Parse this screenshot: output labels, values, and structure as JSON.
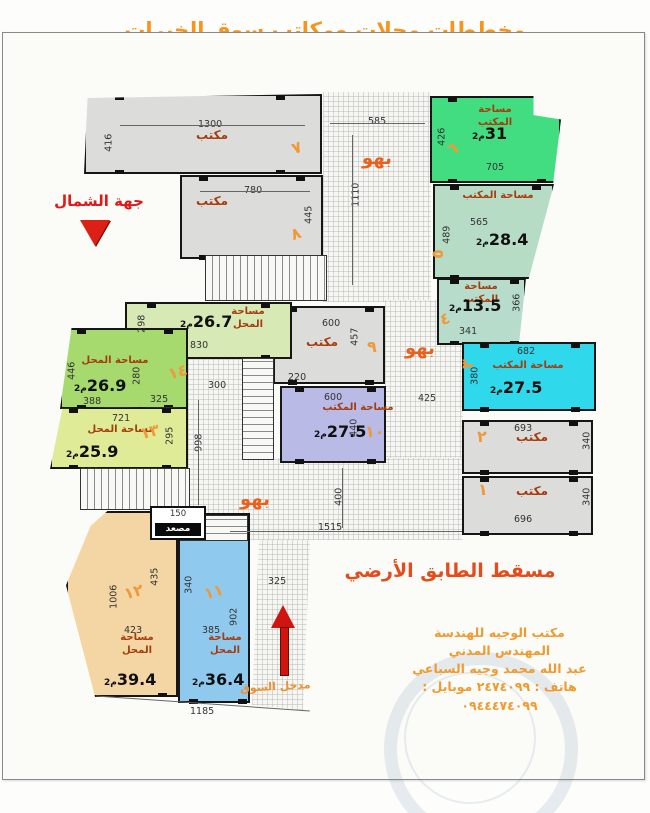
{
  "title": "مخططات محلات ومكاتب سوق الخيرات",
  "north_label": "جهة الشمال",
  "floor_label": "مسقط الطابق الأرضي",
  "entrance_label": "مدخل السوق",
  "elevator_label": "مصعد",
  "unit": "م2",
  "hall_word": "بهو",
  "office_word": "مكتب",
  "colors": {
    "title_orange": "#f8941e",
    "room_number_orange": "#f0993a",
    "room_label_red": "#a53c0e",
    "hall_orange": "#e8611e",
    "north_red": "#e01818",
    "floor_red": "#e34d1d",
    "office_green": "#42dd80",
    "office_pale_green": "#b7dcc6",
    "office_cyan": "#2fd8ea",
    "office_purple": "#b9bae6",
    "shop_blue": "#8fcaee",
    "shop_tan": "#f4d6a4",
    "shop_yellow_green": "#e0eb97",
    "shop_green": "#a6d96e",
    "shop_pale_green": "#d7e9b4",
    "gray_room": "#dcdcda"
  },
  "office_box": {
    "lines": [
      "مكتب الوجيه للهندسة",
      "المهندس المدني",
      "عبد الله محمد وجيه السباعي",
      "هاتف : ٢٤٧٤٠٩٩   موبايل : ٠٩٤٤٤٧٤٠٩٩"
    ]
  },
  "halls": [
    {
      "rect": [
        323,
        92,
        108,
        210
      ],
      "label": "بهو",
      "label_at": [
        362,
        148
      ]
    },
    {
      "rect": [
        385,
        300,
        78,
        162
      ],
      "label": "بهو",
      "label_at": [
        405,
        338
      ]
    },
    {
      "rect": [
        188,
        458,
        274,
        82
      ],
      "label": "بهو",
      "label_at": [
        240,
        489
      ]
    },
    {
      "rect": [
        188,
        355,
        56,
        105
      ]
    },
    {
      "rect": [
        252,
        540,
        58,
        170
      ],
      "clip": "polygon(12% 0,100% 0,88% 100%,0 97%)"
    }
  ],
  "rooms": [
    {
      "num": "٧",
      "label": "مكتب",
      "label_size": 12,
      "label_at": [
        196,
        128
      ],
      "num_at": [
        292,
        140
      ],
      "num_rot": -20,
      "rect": [
        84,
        94,
        238,
        80
      ],
      "color": "#dcdcda",
      "clip": "polygon(1.5% 5%,100% 0,100% 100%,0 100%)"
    },
    {
      "num": "٨",
      "label": "مكتب",
      "label_size": 12,
      "label_at": [
        196,
        194
      ],
      "num_at": [
        291,
        226
      ],
      "num_rot": -20,
      "rect": [
        180,
        175,
        143,
        84
      ],
      "color": "#dcdcda"
    },
    {
      "num": "٩",
      "label": "مكتب",
      "label_size": 12,
      "label_at": [
        306,
        335
      ],
      "num_at": [
        367,
        339
      ],
      "num_rot": 0,
      "rect": [
        273,
        306,
        112,
        78
      ],
      "color": "#dcdcda"
    },
    {
      "num": "٦",
      "label": "مساحة المكتب",
      "label_at": [
        462,
        104
      ],
      "label_w": 66,
      "area": "31",
      "area_at": [
        472,
        126
      ],
      "num_at": [
        448,
        141
      ],
      "num_rot": -25,
      "rect": [
        430,
        96,
        131,
        87
      ],
      "color": "#42dd80",
      "clip": "polygon(0 0,79% 0,79% 22%,100% 27%,94% 100%,0 100%)"
    },
    {
      "num": "٥",
      "label": "مساحة المكتب",
      "label_at": [
        462,
        190
      ],
      "label_w": 72,
      "area": "28.4",
      "area_at": [
        476,
        232
      ],
      "num_at": [
        433,
        246
      ],
      "num_rot": -90,
      "rect": [
        433,
        184,
        121,
        95
      ],
      "color": "#b7dcc6",
      "clip": "polygon(0 0,100% 0,79% 100%,0 100%)"
    },
    {
      "num": "٤",
      "label": "مساحة المكتب",
      "label_at": [
        449,
        281
      ],
      "label_w": 64,
      "area": "13.5",
      "area_at": [
        449,
        298
      ],
      "num_at": [
        440,
        311
      ],
      "num_rot": -20,
      "rect": [
        437,
        278,
        89,
        67
      ],
      "color": "#b7dccc",
      "clip": "polygon(0 0,100% 0,92% 100%,0 100%)"
    },
    {
      "num": "٣",
      "label": "مساحة المكتب",
      "label_at": [
        488,
        360
      ],
      "label_w": 80,
      "area": "27.5",
      "area_at": [
        490,
        380
      ],
      "num_at": [
        463,
        356
      ],
      "num_rot": -90,
      "rect": [
        462,
        342,
        134,
        69
      ],
      "color": "#2fd8ea"
    },
    {
      "num": "٢",
      "label": "مكتب",
      "label_size": 12,
      "label_at": [
        516,
        430
      ],
      "num_at": [
        477,
        429
      ],
      "num_rot": 0,
      "rect": [
        462,
        420,
        131,
        54
      ],
      "color": "#dcdcda"
    },
    {
      "num": "١",
      "label": "مكتب",
      "label_size": 12,
      "label_at": [
        516,
        484
      ],
      "num_at": [
        478,
        482
      ],
      "num_rot": 0,
      "rect": [
        462,
        476,
        131,
        59
      ],
      "color": "#dcdcda"
    },
    {
      "num": "١٠",
      "label": "مساحة المكتب",
      "label_at": [
        322,
        402
      ],
      "label_w": 72,
      "area": "27.5",
      "area_at": [
        314,
        424
      ],
      "num_at": [
        365,
        424
      ],
      "num_rot": 0,
      "rect": [
        280,
        386,
        106,
        77
      ],
      "color": "#b9bae6"
    },
    {
      "num": "١٥",
      "label": "مساحة المحل",
      "label_at": [
        222,
        306
      ],
      "label_w": 52,
      "area": "26.7",
      "area_at": [
        180,
        314
      ],
      "num_at": [
        148,
        330
      ],
      "num_rot": -15,
      "rect": [
        125,
        302,
        167,
        57
      ],
      "color": "#d7e9b4"
    },
    {
      "num": "١٤",
      "label": "مساحة المحل",
      "label_at": [
        76,
        355
      ],
      "label_w": 78,
      "area": "26.9",
      "area_at": [
        74,
        378
      ],
      "num_at": [
        168,
        364
      ],
      "num_rot": -15,
      "rect": [
        60,
        328,
        128,
        81
      ],
      "color": "#a6d96e",
      "clip": "polygon(9% 0,100% 0,100% 100%,0 100%)"
    },
    {
      "num": "١٣",
      "label": "مساحة المحل",
      "label_at": [
        82,
        424
      ],
      "label_w": 78,
      "area": "25.9",
      "area_at": [
        66,
        444
      ],
      "num_at": [
        140,
        424
      ],
      "num_rot": -15,
      "rect": [
        50,
        407,
        138,
        62
      ],
      "color": "#e0eb97",
      "clip": "polygon(9% 2%,100% 0,100% 100%,0 100%)"
    },
    {
      "num": "١٢",
      "label": "مساحة المحل",
      "label_at": [
        112,
        632
      ],
      "label_w": 50,
      "area": "39.4",
      "area_at": [
        104,
        672
      ],
      "num_at": [
        124,
        584
      ],
      "num_rot": -15,
      "rect": [
        66,
        511,
        112,
        186
      ],
      "color": "#f4d6a4",
      "clip": "polygon(37% 0,100% 0,100% 100%,26% 100%,0 40%,22% 8%)"
    },
    {
      "num": "١١",
      "label": "مساحة المحل",
      "label_at": [
        200,
        632
      ],
      "label_w": 50,
      "area": "36.4",
      "area_at": [
        192,
        672
      ],
      "num_at": [
        204,
        584
      ],
      "num_rot": -15,
      "rect": [
        178,
        513,
        72,
        190
      ],
      "color": "#8fcaee"
    }
  ],
  "dims": [
    {
      "t": "1300",
      "x": 198,
      "y": 120
    },
    {
      "t": "416",
      "x": 100,
      "y": 138,
      "v": true
    },
    {
      "t": "585",
      "x": 368,
      "y": 117
    },
    {
      "t": "1110",
      "x": 344,
      "y": 190,
      "v": true
    },
    {
      "t": "426",
      "x": 433,
      "y": 132,
      "v": true
    },
    {
      "t": "705",
      "x": 486,
      "y": 163
    },
    {
      "t": "565",
      "x": 470,
      "y": 218
    },
    {
      "t": "489",
      "x": 438,
      "y": 230,
      "v": true
    },
    {
      "t": "366",
      "x": 508,
      "y": 298,
      "v": true
    },
    {
      "t": "341",
      "x": 459,
      "y": 327
    },
    {
      "t": "682",
      "x": 517,
      "y": 347
    },
    {
      "t": "380",
      "x": 466,
      "y": 371,
      "v": true
    },
    {
      "t": "425",
      "x": 418,
      "y": 394
    },
    {
      "t": "693",
      "x": 514,
      "y": 424
    },
    {
      "t": "340",
      "x": 578,
      "y": 436,
      "v": true
    },
    {
      "t": "696",
      "x": 514,
      "y": 515
    },
    {
      "t": "340",
      "x": 578,
      "y": 492,
      "v": true
    },
    {
      "t": "780",
      "x": 244,
      "y": 186
    },
    {
      "t": "445",
      "x": 300,
      "y": 210,
      "v": true
    },
    {
      "t": "600",
      "x": 322,
      "y": 319
    },
    {
      "t": "457",
      "x": 346,
      "y": 332,
      "v": true
    },
    {
      "t": "220",
      "x": 288,
      "y": 373
    },
    {
      "t": "600",
      "x": 324,
      "y": 393
    },
    {
      "t": "440",
      "x": 345,
      "y": 423,
      "v": true
    },
    {
      "t": "298",
      "x": 133,
      "y": 319,
      "v": true
    },
    {
      "t": "830",
      "x": 190,
      "y": 341
    },
    {
      "t": "300",
      "x": 208,
      "y": 381
    },
    {
      "t": "180",
      "x": 246,
      "y": 380
    },
    {
      "t": "446",
      "x": 63,
      "y": 366,
      "v": true
    },
    {
      "t": "280",
      "x": 128,
      "y": 371,
      "v": true
    },
    {
      "t": "388",
      "x": 83,
      "y": 397
    },
    {
      "t": "325",
      "x": 150,
      "y": 395
    },
    {
      "t": "721",
      "x": 112,
      "y": 414
    },
    {
      "t": "295",
      "x": 161,
      "y": 431,
      "v": true
    },
    {
      "t": "998",
      "x": 190,
      "y": 438,
      "v": true
    },
    {
      "t": "130",
      "x": 206,
      "y": 257
    },
    {
      "t": "139",
      "x": 303,
      "y": 258
    },
    {
      "t": "160",
      "x": 300,
      "y": 283
    },
    {
      "t": "130",
      "x": 81,
      "y": 467
    },
    {
      "t": "1006",
      "x": 102,
      "y": 592,
      "v": true
    },
    {
      "t": "435",
      "x": 146,
      "y": 572,
      "v": true
    },
    {
      "t": "423",
      "x": 124,
      "y": 626
    },
    {
      "t": "340",
      "x": 180,
      "y": 580,
      "v": true
    },
    {
      "t": "902",
      "x": 225,
      "y": 612,
      "v": true
    },
    {
      "t": "385",
      "x": 202,
      "y": 626
    },
    {
      "t": "325",
      "x": 268,
      "y": 577
    },
    {
      "t": "400",
      "x": 330,
      "y": 492,
      "v": true
    },
    {
      "t": "1515",
      "x": 318,
      "y": 523
    },
    {
      "t": "1185",
      "x": 190,
      "y": 707
    }
  ]
}
